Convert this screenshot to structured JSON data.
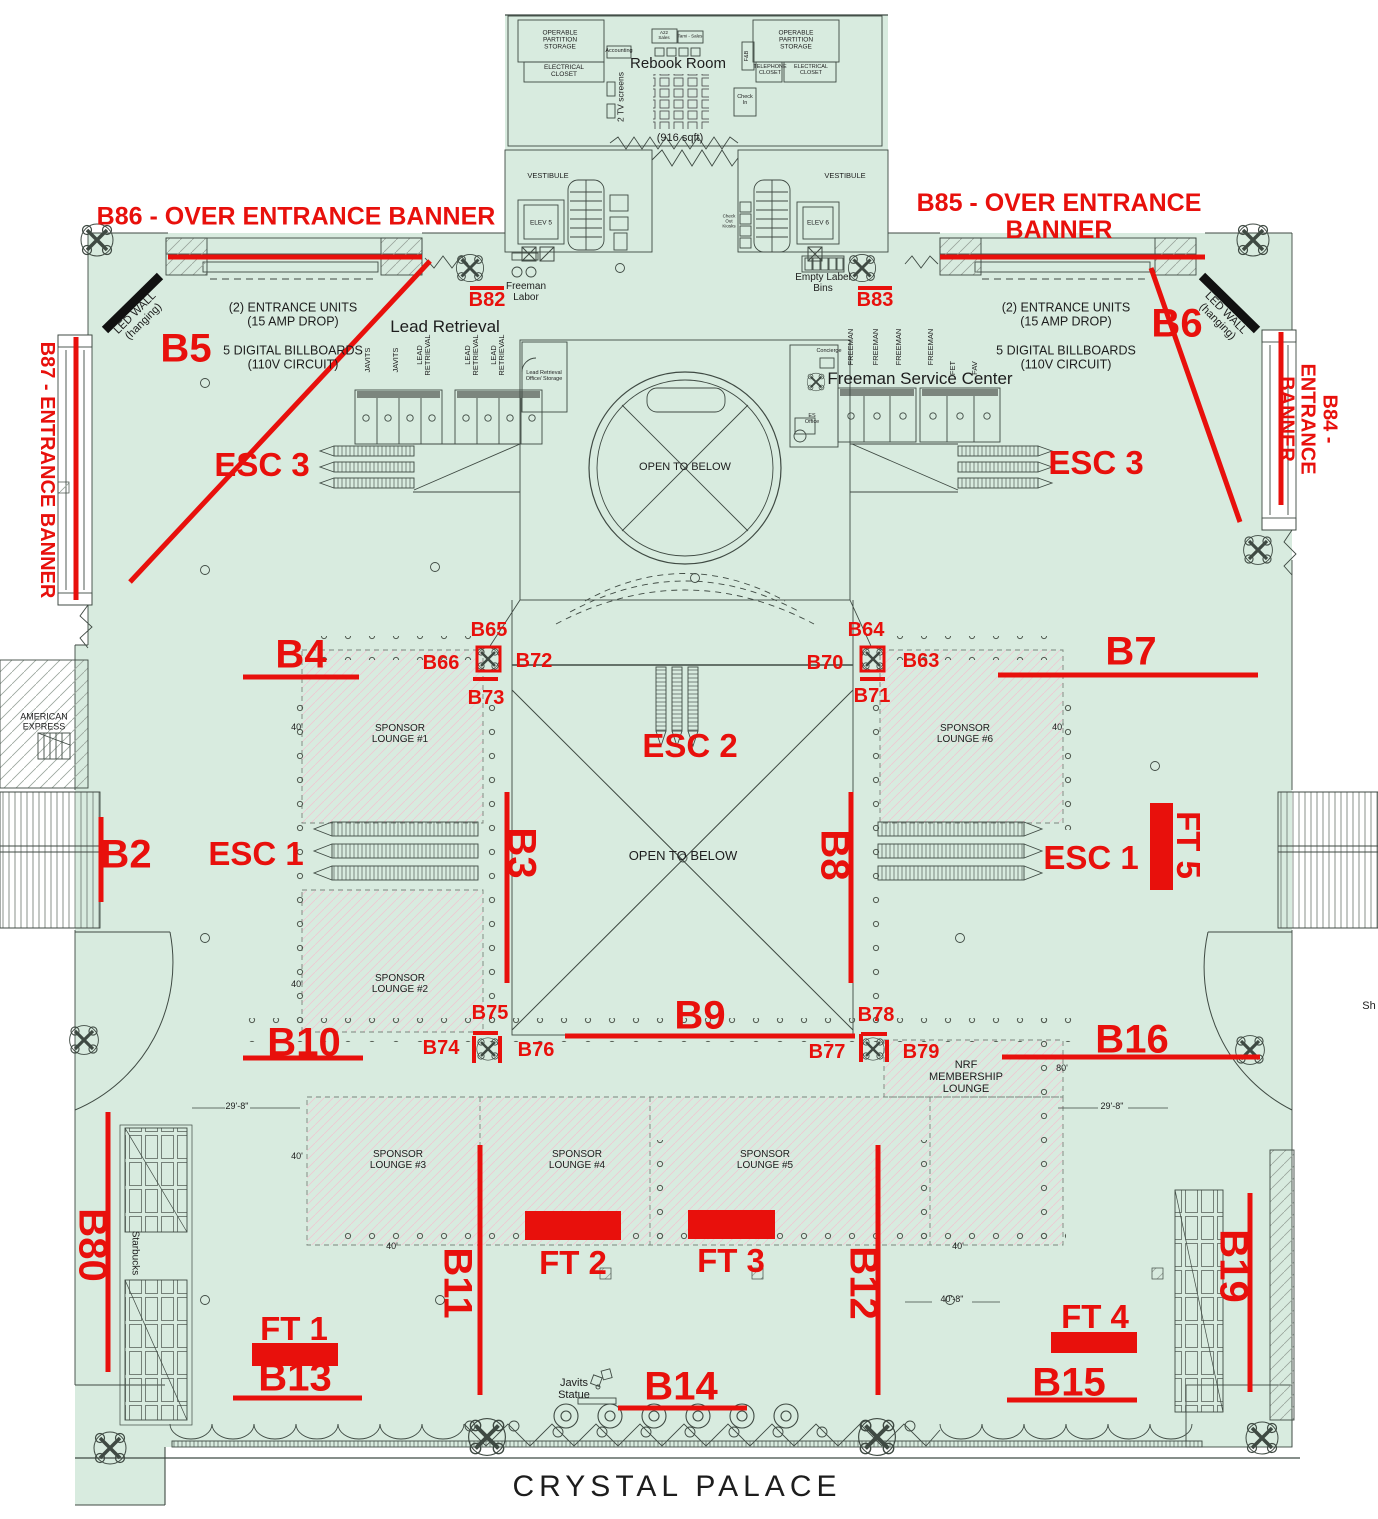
{
  "colors": {
    "floor": "#d8ebdf",
    "annotation_red": "#e8100c",
    "wall": "#3f4a43",
    "hatch_pink": "#edc9d2"
  },
  "red": {
    "b86": "B86 - OVER ENTRANCE BANNER",
    "b85": "B85 - OVER ENTRANCE BANNER",
    "b87": "B87 - ENTRANCE BANNER",
    "b84": "B84 - ENTRANCE BANNER",
    "b2": "B2",
    "b3": "B3",
    "b4": "B4",
    "b5": "B5",
    "b6": "B6",
    "b7": "B7",
    "b8": "B8",
    "b9": "B9",
    "b10": "B10",
    "b11": "B11",
    "b12": "B12",
    "b13": "B13",
    "b14": "B14",
    "b15": "B15",
    "b16": "B16",
    "b19": "B19",
    "b63": "B63",
    "b64": "B64",
    "b65": "B65",
    "b66": "B66",
    "b70": "B70",
    "b71": "B71",
    "b72": "B72",
    "b73": "B73",
    "b74": "B74",
    "b75": "B75",
    "b76": "B76",
    "b77": "B77",
    "b78": "B78",
    "b79": "B79",
    "b80": "B80",
    "b82": "B82",
    "b83": "B83",
    "ft1": "FT 1",
    "ft2": "FT 2",
    "ft3": "FT 3",
    "ft4": "FT 4",
    "ft5": "FT 5",
    "esc1": "ESC 1",
    "esc2": "ESC 2",
    "esc3": "ESC 3"
  },
  "rooms": {
    "rebook": "Rebook Room",
    "sqft": "(916 sqft)",
    "operable": "OPERABLE\nPARTITION\nSTORAGE",
    "electrical": "ELECTRICAL\nCLOSET",
    "telephone": "TELEPHONE\nCLOSET",
    "accounting": "Accounting",
    "a22": "A22\nSales",
    "tami": "Tami - Sales",
    "tv": "2 TV screens",
    "fnb": "F&B",
    "checkin": "Check\nIn",
    "checkout": "Check\nOut\nKiosks",
    "vestibule": "VESTIBULE",
    "elev5": "ELEV 5",
    "elev6": "ELEV 6",
    "freeman_labor": "Freeman\nLabor",
    "bins": "Empty Label\nBins",
    "lead_title": "Lead Retrieval",
    "lead_office": "Lead Retrieval\nOffice/ Storage",
    "fsc": "Freeman Service Center",
    "concierge": "Concierge",
    "es_office": "ES\nOffice",
    "open_below": "OPEN TO BELOW",
    "nrf": "NRF\nMEMBERSHIP\nLOUNGE",
    "amex": "AMERICAN\nEXPRESS",
    "starbucks": "Starbucks",
    "javits_statue": "Javits\nStatue",
    "sh": "Sh",
    "crystal": "CRYSTAL PALACE"
  },
  "counters": {
    "javits": "JAVITS",
    "lead": "LEAD\nRETRIEVAL",
    "freeman": "FREEMAN",
    "fet": "FET",
    "fav": "FAV"
  },
  "lounges": {
    "l1": "SPONSOR\nLOUNGE #1",
    "l2": "SPONSOR\nLOUNGE #2",
    "l3": "SPONSOR\nLOUNGE #3",
    "l4": "SPONSOR\nLOUNGE #4",
    "l5": "SPONSOR\nLOUNGE #5",
    "l6": "SPONSOR\nLOUNGE #6"
  },
  "notes": {
    "entrance": "(2) ENTRANCE UNITS\n(15 AMP DROP)",
    "billboards": "5 DIGITAL BILLBOARDS\n(110V CIRCUIT)",
    "led": "LED WALL\n(hanging)"
  },
  "dims": {
    "d40": "40'",
    "d80": "80'",
    "d298": "29'-8\"",
    "d408": "40'-8\""
  }
}
